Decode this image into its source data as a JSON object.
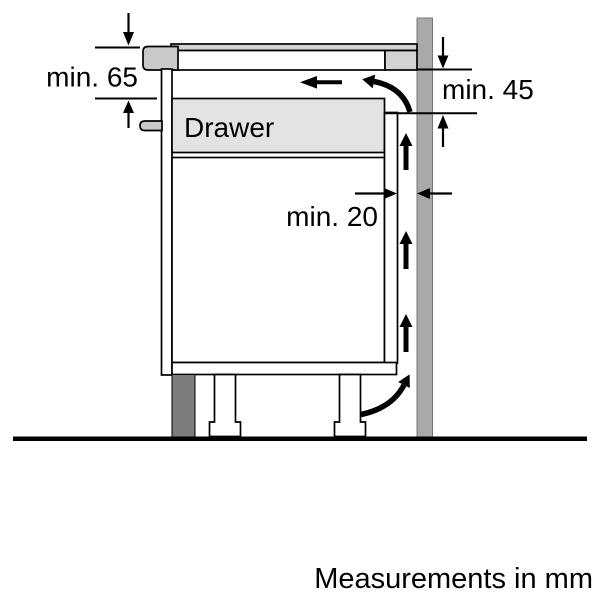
{
  "labels": {
    "min_65": "min. 65",
    "min_45": "min. 45",
    "min_20": "min. 20",
    "drawer": "Drawer",
    "footer": "Measurements in mm"
  },
  "measurements": [
    {
      "id": "worktop-to-drawer-clearance",
      "label": "min. 65",
      "unit": "mm"
    },
    {
      "id": "hob-underside-clearance",
      "label": "min. 45",
      "unit": "mm"
    },
    {
      "id": "rear-ventilation-gap",
      "label": "min. 20",
      "unit": "mm"
    }
  ],
  "colors": {
    "line": "#000000",
    "drawer_fill": "#e3e3e3",
    "worktop_fill": "#d3d3d3",
    "trim_fill": "#c9c9c9",
    "wall_fill": "#a9a9a9",
    "plinth_fill": "#7d7d7d",
    "background": "#ffffff"
  }
}
